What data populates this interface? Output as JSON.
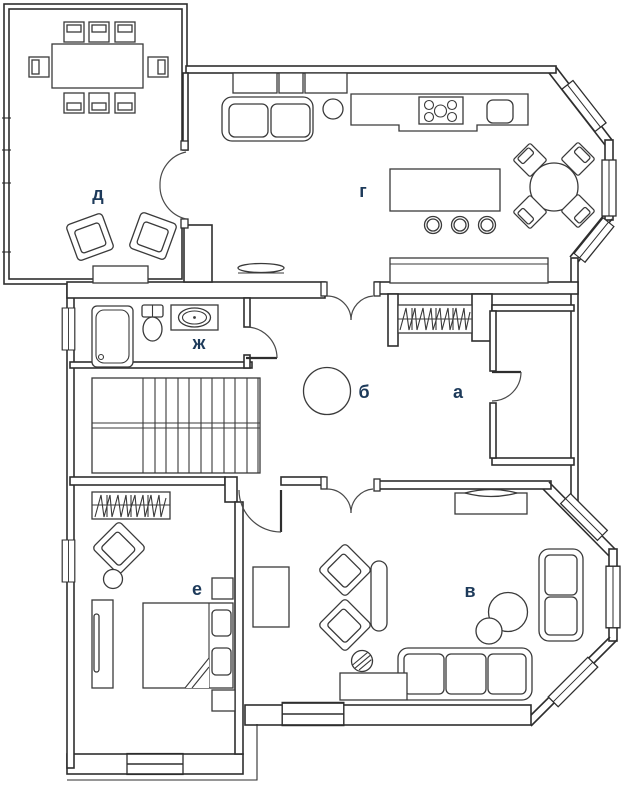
{
  "plan": {
    "name": "apartment-floor-plan",
    "background": "#ffffff",
    "line_color": "#2e2e2e",
    "label_color": "#1d3a5a",
    "rooms": [
      {
        "label": "д"
      },
      {
        "label": "г"
      },
      {
        "label": "ж"
      },
      {
        "label": "б"
      },
      {
        "label": "а"
      },
      {
        "label": "е"
      },
      {
        "label": "в"
      }
    ],
    "furniture_icons": [
      "dining-table",
      "dining-chair",
      "armchair",
      "sideboard",
      "double-door",
      "door",
      "kitchen-counter",
      "stove",
      "kitchen-sink",
      "kitchen-island",
      "bar-stool",
      "sofa",
      "round-table",
      "side-table",
      "bathtub",
      "toilet",
      "washbasin",
      "staircase",
      "wardrobe-with-hangers",
      "radiator",
      "closet",
      "bed",
      "pillow",
      "nightstand",
      "tv",
      "tv-cabinet",
      "dresser",
      "bench",
      "coffee-tables",
      "stool",
      "window"
    ]
  }
}
